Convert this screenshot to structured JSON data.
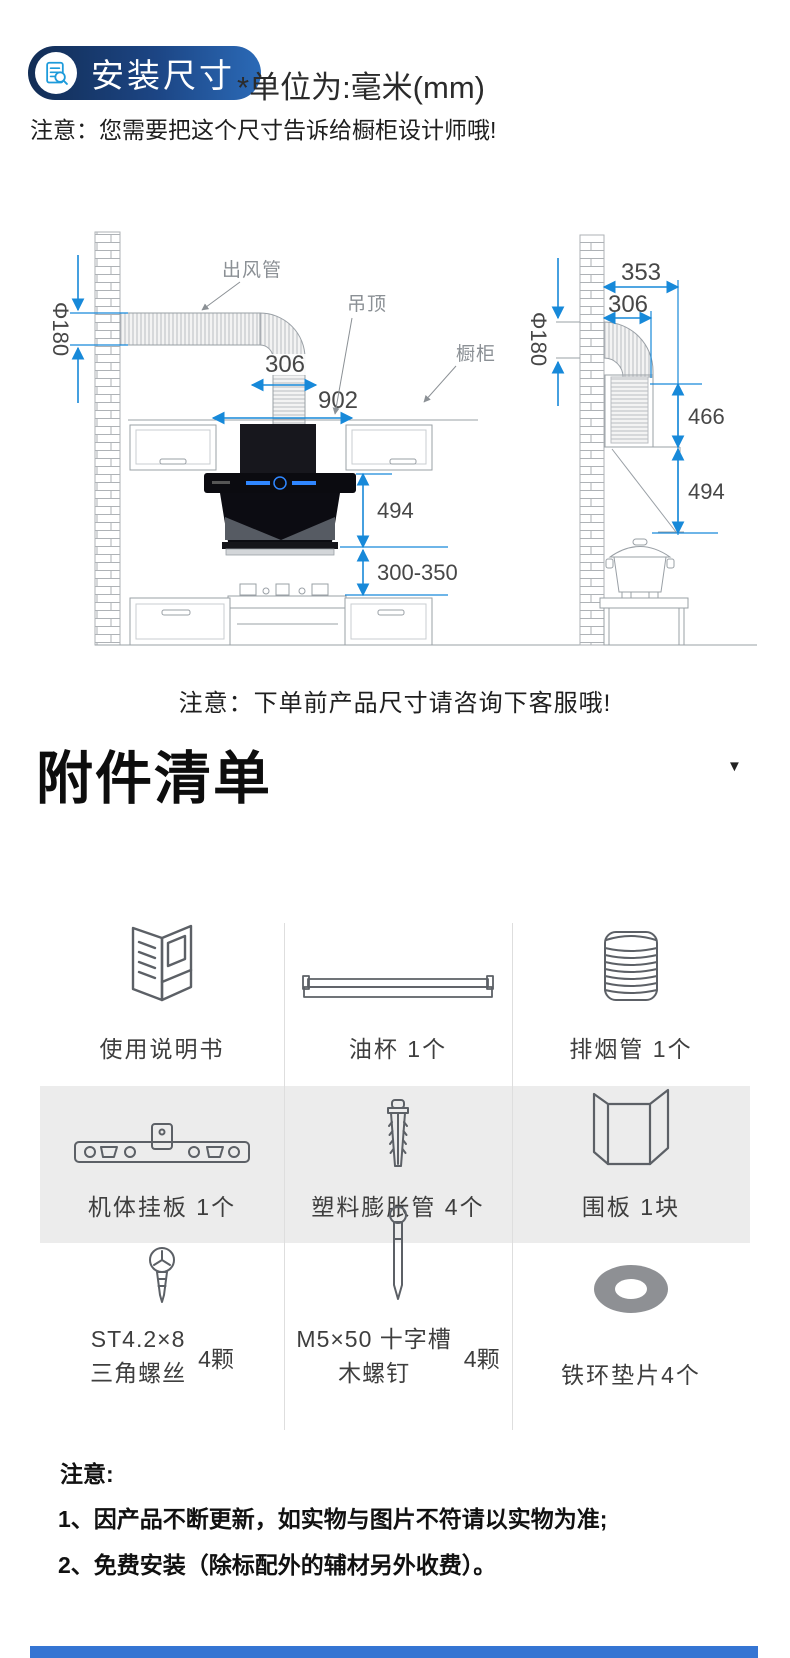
{
  "header": {
    "badge": {
      "label": "安装尺寸",
      "icon": "document-magnifier-icon"
    },
    "unit_note": "*单位为:毫米(mm)",
    "notice": "注意：您需要把这个尺寸告诉给橱柜设计师哦!"
  },
  "diagram": {
    "callouts": {
      "outlet_pipe": "出风管",
      "ceiling": "吊顶",
      "cabinet": "橱柜"
    },
    "front_view": {
      "duct_diameter": "Φ180",
      "ceiling_hole_width": "306",
      "hood_width": "902",
      "hood_height": "494",
      "distance_to_stove": "300-350"
    },
    "side_view": {
      "total_depth": "353",
      "duct_depth": "306",
      "duct_diameter": "Φ180",
      "chimney_height": "466",
      "hood_height": "494"
    },
    "note": "注意：下单前产品尺寸请咨询下客服哦!"
  },
  "accessories": {
    "title": "附件清单",
    "items": [
      {
        "label": "使用说明书",
        "icon": "manual-icon"
      },
      {
        "label": "油杯 1个",
        "icon": "oil-cup-icon"
      },
      {
        "label": "排烟管 1个",
        "icon": "exhaust-pipe-icon"
      },
      {
        "label": "机体挂板 1个",
        "icon": "hanging-plate-icon"
      },
      {
        "label": "塑料膨胀管 4个",
        "icon": "wall-anchor-icon"
      },
      {
        "label": "围板 1块",
        "icon": "surround-board-icon"
      },
      {
        "line1": "ST4.2×8",
        "line2": "三角螺丝",
        "qty": "4颗",
        "icon": "triangle-screw-icon"
      },
      {
        "line1": "M5×50 十字槽",
        "line2": "木螺钉",
        "qty": "4颗",
        "icon": "wood-screw-icon"
      },
      {
        "label": "铁环垫片4个",
        "icon": "washer-icon"
      }
    ]
  },
  "footer": {
    "title": "注意:",
    "notes": [
      "1、因产品不断更新，如实物与图片不符请以实物为准;",
      "2、免费安装（除标配外的辅材另外收费）。"
    ]
  },
  "colors": {
    "badge_gradient_start": "#122d55",
    "badge_gradient_end": "#2b6ab7",
    "badge_icon_blue": "#1d9bdb",
    "dimension_blue": "#1789d9",
    "line_gray": "#9aa0a6",
    "row_band_gray": "#ececec",
    "bottom_bar_blue": "#3575d3"
  }
}
